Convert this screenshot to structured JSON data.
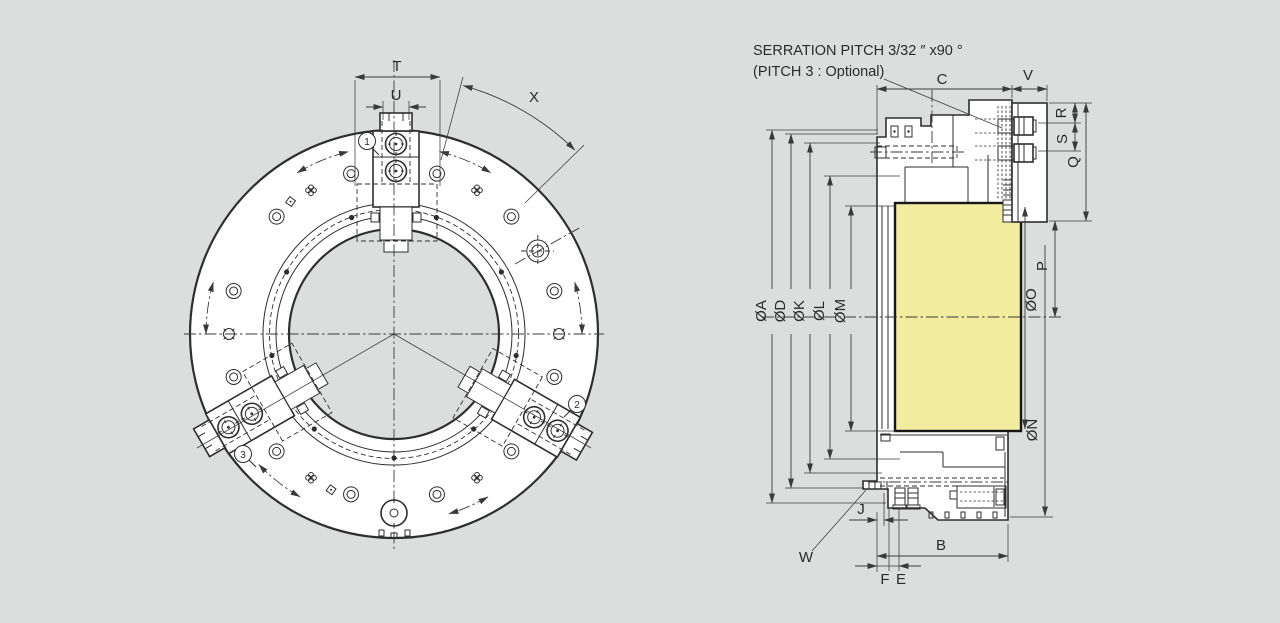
{
  "colors": {
    "background": "#dcdddd",
    "line": "#2e2e2e",
    "highlight": "#f1ec9e"
  },
  "front_view": {
    "dim_labels": {
      "T": "T",
      "U": "U",
      "X": "X"
    },
    "balloons": [
      {
        "label": "1"
      },
      {
        "label": "2"
      },
      {
        "label": "3"
      }
    ]
  },
  "section_view": {
    "serration_note_line1": "SERRATION PITCH 3/32 ″ x90 °",
    "serration_note_line2": "(PITCH 3 : Optional)",
    "dim_labels": {
      "C": "C",
      "V": "V",
      "R": "R",
      "S": "S",
      "Q": "Q",
      "P": "P",
      "O": "ØO",
      "N": "ØN",
      "A": "ØA",
      "D": "ØD",
      "K": "ØK",
      "L": "ØL",
      "M": "ØM",
      "B": "B",
      "F": "F",
      "E": "E",
      "J": "J",
      "W": "W"
    }
  }
}
